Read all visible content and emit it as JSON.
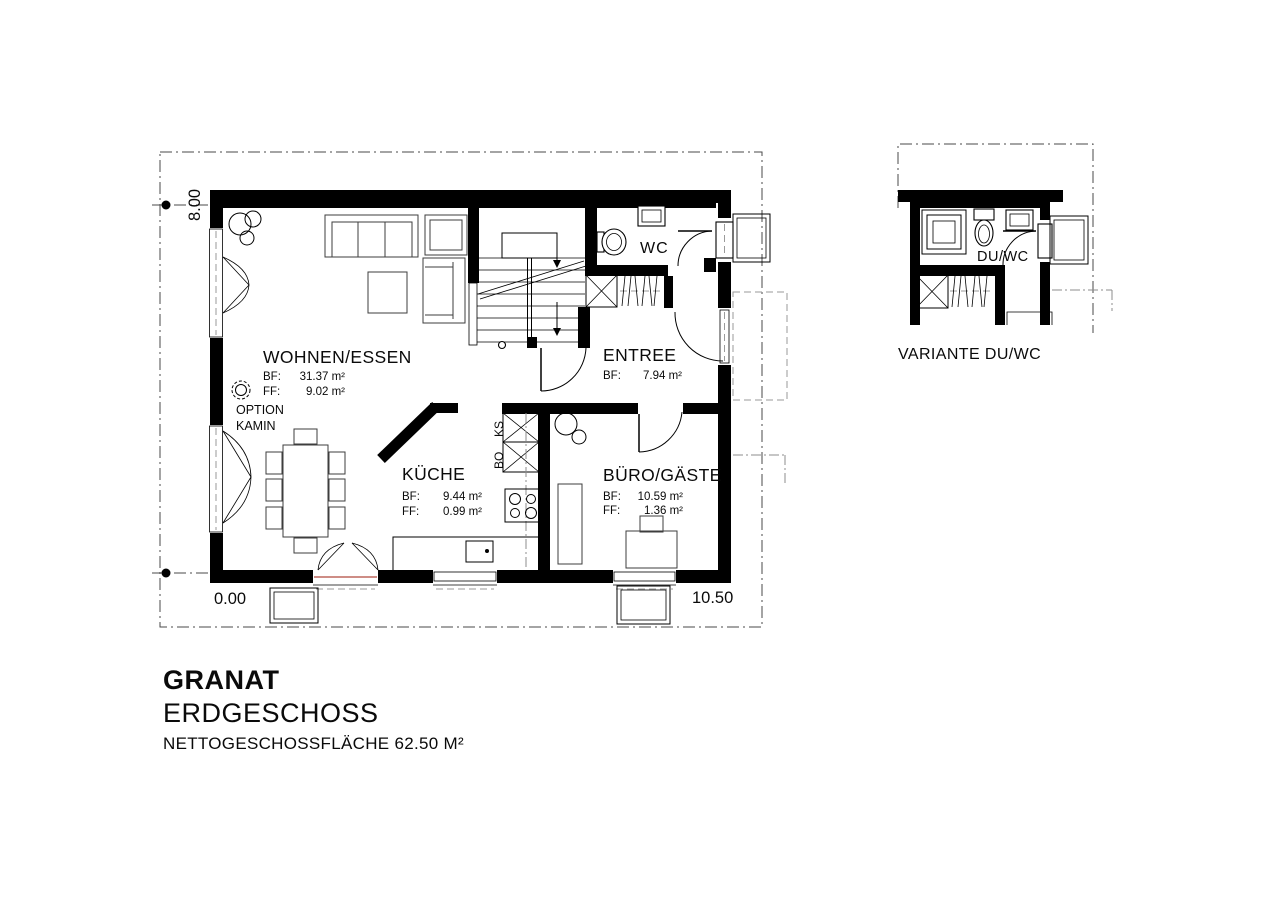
{
  "project": {
    "name": "GRANAT",
    "floor": "ERDGESCHOSS",
    "area_note": "NETTOGESCHOSSFLÄCHE 62.50 M²"
  },
  "dimensions": {
    "vertical": "8.00",
    "origin": "0.00",
    "horizontal": "10.50"
  },
  "rooms": {
    "living": {
      "name": "WOHNEN/ESSEN",
      "bf_label": "BF:",
      "bf_value": "31.37 m²",
      "ff_label": "FF:",
      "ff_value": "9.02 m²"
    },
    "kitchen": {
      "name": "KÜCHE",
      "bf_label": "BF:",
      "bf_value": "9.44 m²",
      "ff_label": "FF:",
      "ff_value": "0.99 m²"
    },
    "entree": {
      "name": "ENTREE",
      "bf_label": "BF:",
      "bf_value": "7.94 m²"
    },
    "wc": {
      "name": "WC"
    },
    "office": {
      "name": "BÜRO/GÄSTE",
      "bf_label": "BF:",
      "bf_value": "10.59 m²",
      "ff_label": "FF:",
      "ff_value": "1.36 m²"
    }
  },
  "annotations": {
    "option_line1": "OPTION",
    "option_line2": "KAMIN",
    "fridge": "KS",
    "oven": "BO"
  },
  "variant": {
    "room_label": "DU/WC",
    "caption": "VARIANTE DU/WC"
  },
  "colors": {
    "ink": "#000000",
    "reference_gray": "#9a9a9a",
    "sill_red": "#b0493f"
  }
}
